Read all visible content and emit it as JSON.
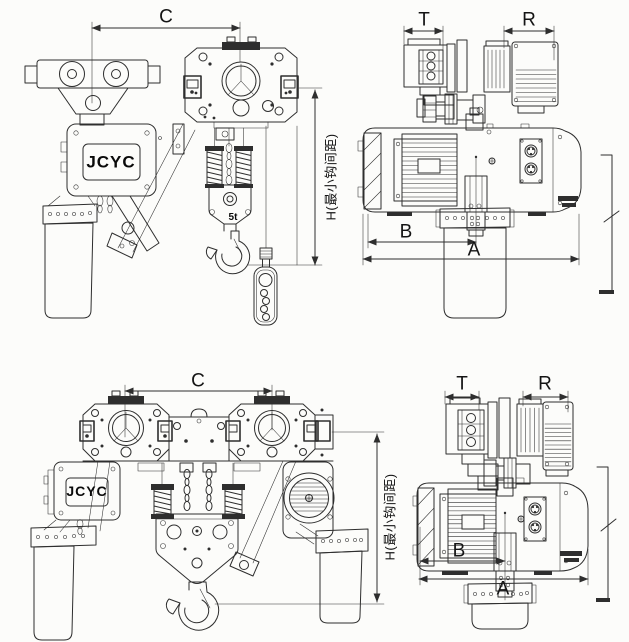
{
  "figures": {
    "top": {
      "front_view": {
        "dim_width": "C",
        "dim_hook_headroom": "H(最小钩间距)",
        "brand": "JCYC",
        "capacity": "5t"
      },
      "side_view": {
        "dim_t": "T",
        "dim_r": "R",
        "dim_b": "B",
        "dim_a": "A"
      }
    },
    "bottom": {
      "front_view": {
        "dim_width": "C",
        "dim_hook_headroom": "H(最小钩间距)",
        "brand": "JCYC"
      },
      "side_view": {
        "dim_t": "T",
        "dim_r": "R",
        "dim_b": "B",
        "dim_a": "A"
      }
    }
  },
  "colors": {
    "line": "#2e2e2e",
    "paper": "#fcfcfa",
    "text": "#141414"
  }
}
